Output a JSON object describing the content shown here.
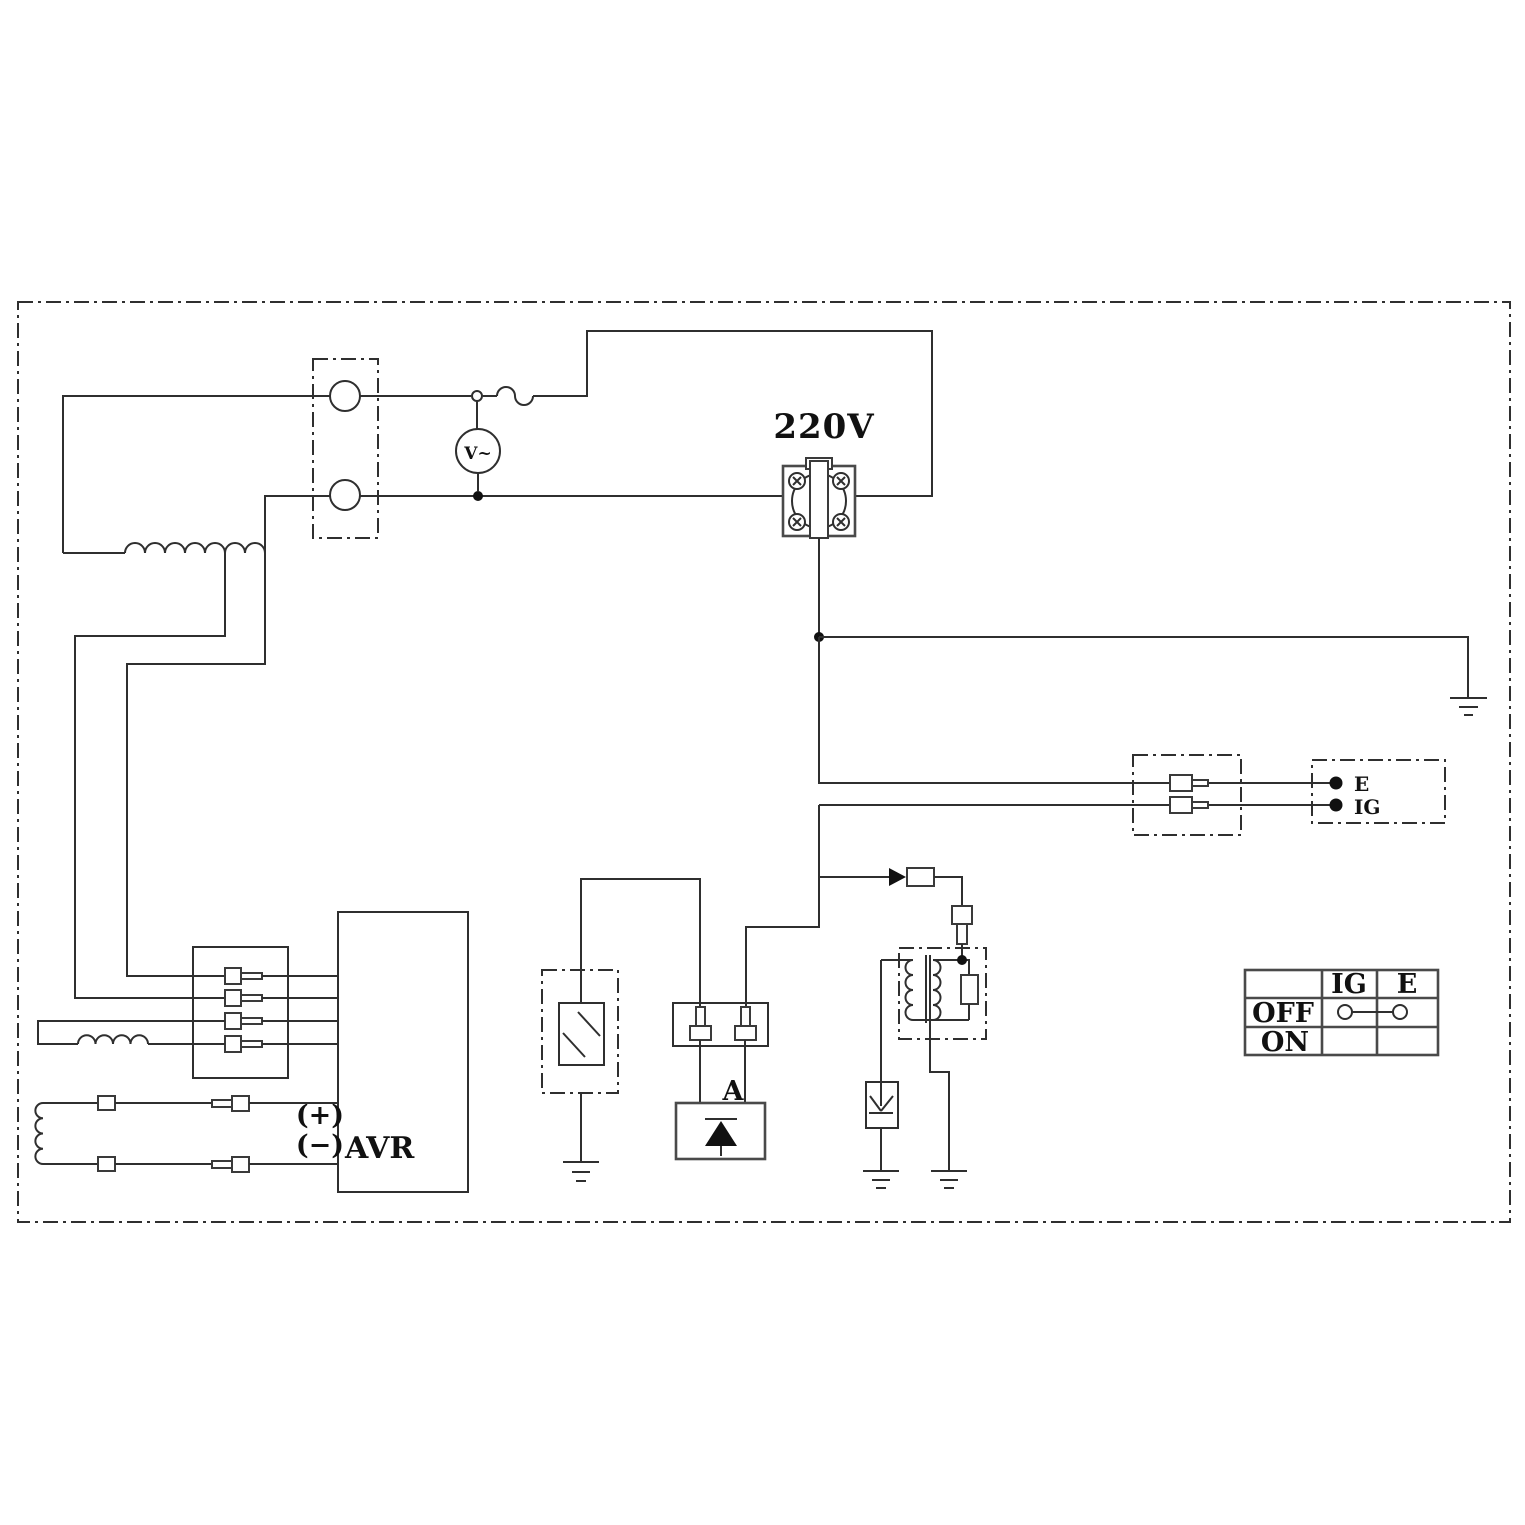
{
  "diagram": {
    "title": "Generator wiring schematic",
    "colors": {
      "line": "#2f2f2f",
      "background": "#ffffff",
      "text": "#111111"
    },
    "labels": {
      "outlet_voltage": "220V",
      "voltmeter": "V~",
      "avr": "AVR",
      "avr_plus": "(+)",
      "avr_minus": "(−)",
      "rectifier": "A",
      "terminal_e": "E",
      "terminal_ig": "IG"
    },
    "switch_table": {
      "headers": {
        "ig": "IG",
        "e": "E"
      },
      "rows": {
        "off": "OFF",
        "on": "ON"
      }
    }
  }
}
